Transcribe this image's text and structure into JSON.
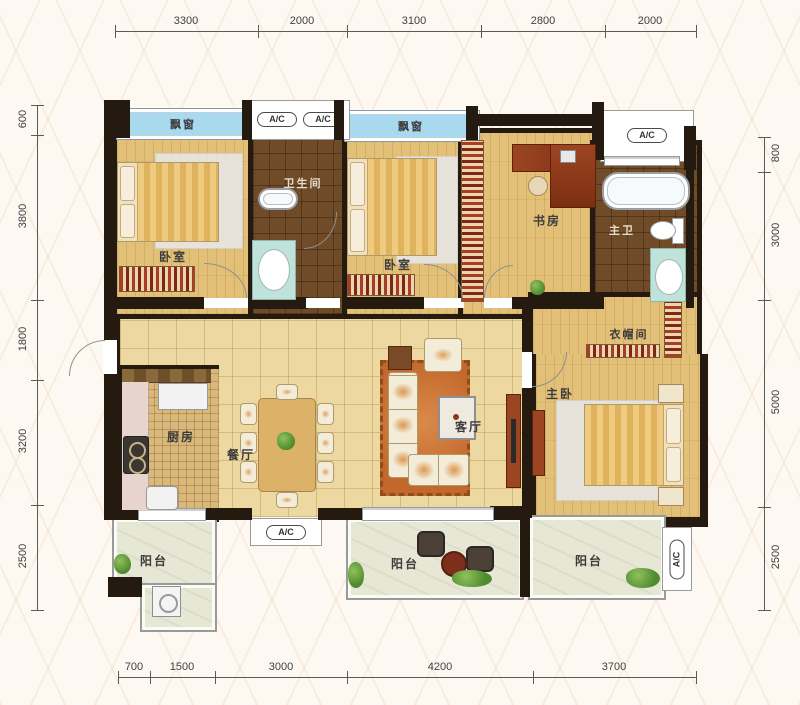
{
  "dimensions": {
    "top": [
      "3300",
      "2000",
      "3100",
      "2800",
      "2000"
    ],
    "bottom": [
      "700",
      "1500",
      "3000",
      "4200",
      "3700"
    ],
    "left": [
      "600",
      "3800",
      "1800",
      "3200",
      "2500"
    ],
    "right": [
      "800",
      "3000",
      "5000",
      "2500"
    ]
  },
  "labels": {
    "bay_window": "飘窗",
    "ac": "A/C",
    "bedroom": "卧室",
    "bathroom": "卫生间",
    "study": "书房",
    "master_bath": "主卫",
    "cloakroom": "衣帽间",
    "master_bedroom": "主卧",
    "kitchen": "厨房",
    "dining": "餐厅",
    "living": "客厅",
    "balcony": "阳台"
  },
  "colors": {
    "background": "#fdf8f2",
    "wall": "#241a10",
    "bay_window": "#a9d9ee",
    "wood_floor": "#e2c078",
    "hall_tile": "#ecd8a0",
    "dark_tile": "#6f4b28",
    "balcony_floor": "#e7e7d5",
    "rug": "#d0763a",
    "dimension_line": "#5a5a5a"
  }
}
